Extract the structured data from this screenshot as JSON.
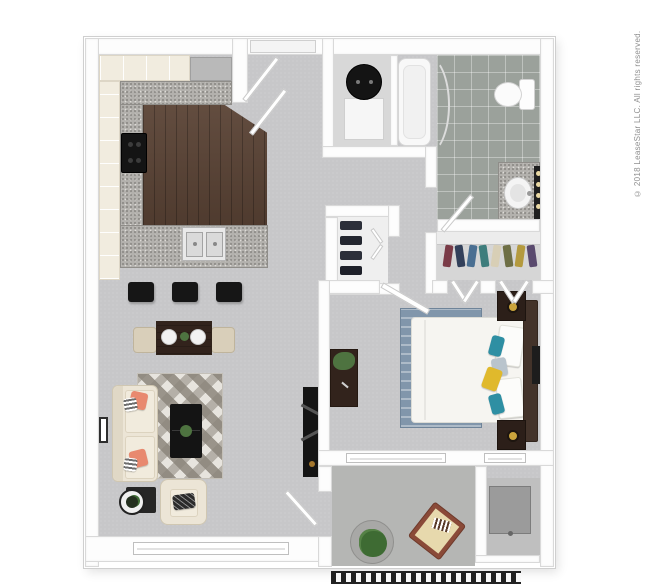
{
  "copyright": "© 2018 LeaseStar LLC. All rights reserved.",
  "palette": {
    "background": "#ffffff",
    "wall": "#fdfdfd",
    "wall_edge": "#d9d9d9",
    "carpet": "#c7c7c9",
    "kitchen_wood": "#5a4335",
    "granite": "#b3b1ad",
    "cabinet_cream": "#f1ecdf",
    "appliance_gray": "#b9b9b9",
    "bathroom_tile": "#9ba19b",
    "patio_concrete": "#b5b6b4",
    "storage_floor": "#bfbfbf",
    "closet_floor": "#d6d6d6",
    "bed_rug_blue": "#8196ab",
    "accent_teal": "#2e8fa3",
    "accent_yellow": "#e0b92c",
    "accent_coral": "#e8896f",
    "dark_wood": "#32231c",
    "black_furniture": "#141414",
    "plant_green": "#4e7340",
    "lamp_gold": "#caa43c",
    "white_fixture": "#f8f8f8"
  },
  "kitchen": {
    "stool_colors": [
      "#161616",
      "#161616",
      "#161616"
    ]
  },
  "walkin_closet": {
    "clothes_colors": [
      "#7a3b47",
      "#32405a",
      "#4a6f92",
      "#3e7d7c",
      "#d8cfb6",
      "#6e6f45",
      "#b49a3e",
      "#5a4a6e"
    ]
  },
  "linen_closet": {
    "item_colors": [
      "#2c2f3a",
      "#23262f",
      "#2c2f3a",
      "#1e2029"
    ]
  },
  "bathroom": {
    "vanity_light_colors": [
      "#ead9a4",
      "#ead9a4",
      "#ead9a4",
      "#ead9a4"
    ]
  },
  "bedroom": {
    "pillow_colors": [
      "#2e8fa3",
      "#b9c4cc",
      "#e0b92c",
      "#2e8fa3"
    ]
  },
  "living_room": {
    "sofa_pillow_color": "#e8896f"
  }
}
